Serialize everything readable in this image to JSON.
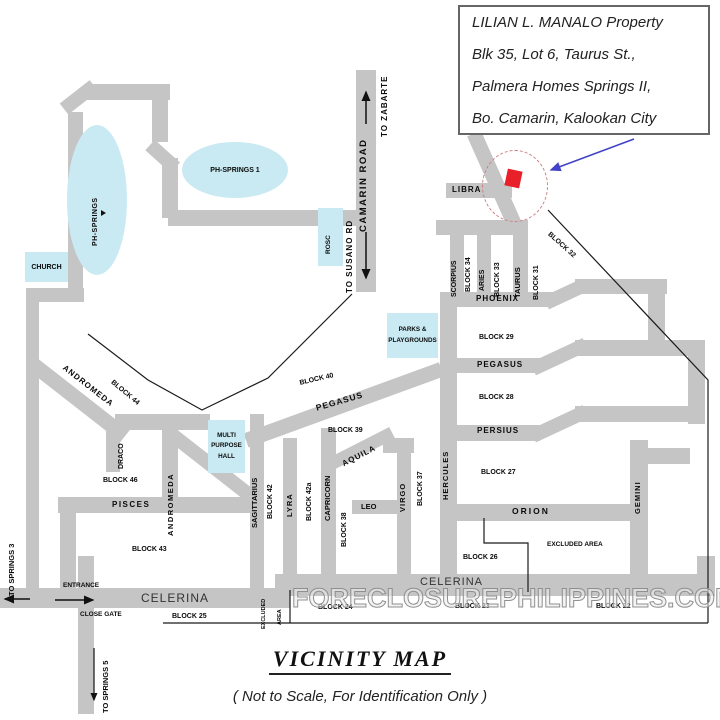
{
  "colors": {
    "road_gray": "#c5c5c5",
    "landmark_fill": "#c9eaf2",
    "marker_red": "#e8202a",
    "arrow_blue": "#4343c8",
    "boundary_black": "#1a1a1a",
    "dashed_circle": "#d07f7f"
  },
  "callout": {
    "line1": "LILIAN L. MANALO  Property",
    "line2": "Blk 35, Lot 6, Taurus  St.,",
    "line3": "Palmera Homes Springs II,",
    "line4": "Bo. Camarin, Kalookan City"
  },
  "legend": {
    "title": "VICINITY  MAP",
    "subtitle": "( Not to Scale, For Identification Only )"
  },
  "watermark": "FORECLOSUREPHILIPPINES.COM",
  "landmarks": {
    "church": "CHURCH",
    "ph_springs": "PH-SPRINGS",
    "ph_springs_1": "PH-SPRINGS  1",
    "rosc": "ROSC",
    "parks": [
      "PARKS &",
      "PLAYGROUNDS"
    ],
    "mph": [
      "MULTI",
      "PURPOSE",
      "HALL"
    ],
    "excluded_area": "EXCLUDED  AREA",
    "excluded_area_v": [
      "EXCLUDED",
      "AREA"
    ],
    "entrance": "ENTRANCE",
    "close_gate": "CLOSE GATE"
  },
  "roads": {
    "camarin": "CAMARIN  ROAD",
    "to_zabarte": "TO  ZABARTE",
    "to_susano": "TO SUSANO  RD",
    "to_springs3": "TO SPRINGS 3",
    "to_springs5": "TO SPRINGS 5",
    "libra": "LIBRA",
    "scorpius": "SCORPIUS",
    "aries": "ARIES",
    "taurus": "TAURUS",
    "phoenix": "PHOENIX",
    "pegasus_right": "PEGASUS",
    "pegasus_diag": "PEGASUS",
    "persius": "PERSIUS",
    "orion": "ORION",
    "hercules": "HERCULES",
    "gemini": "GEMINI",
    "andromeda_diag": "ANDROMEDA",
    "andromeda_v": "ANDROMEDA",
    "draco": "DRACO",
    "pisces": "PISCES",
    "sagittarius": "SAGITTARIUS",
    "lyra": "LYRA",
    "capricorn": "CAPRICORN",
    "aquila": "AQUILA",
    "virgo": "VIRGO",
    "leo": "LEO",
    "celerina_left": "CELERINA",
    "celerina_right": "CELERINA"
  },
  "blocks": {
    "b34": "BLOCK  34",
    "b33": "BLOCK  33",
    "b31": "BLOCK  31",
    "b32": "BLOCK  32",
    "b29": "BLOCK  29",
    "b28": "BLOCK  28",
    "b27": "BLOCK  27",
    "b26": "BLOCK  26",
    "b40": "BLOCK  40",
    "b44": "BLOCK  44",
    "b46": "BLOCK 46",
    "b43": "BLOCK 43",
    "b42": "BLOCK  42",
    "b42a": "BLOCK  42a",
    "b39": "BLOCK  39",
    "b38": "BLOCK  38",
    "b37": "BLOCK  37",
    "b25": "BLOCK 25",
    "b24": "BLOCK 24",
    "b23": "BLOCK 23",
    "b22": "BLOCK 22"
  }
}
